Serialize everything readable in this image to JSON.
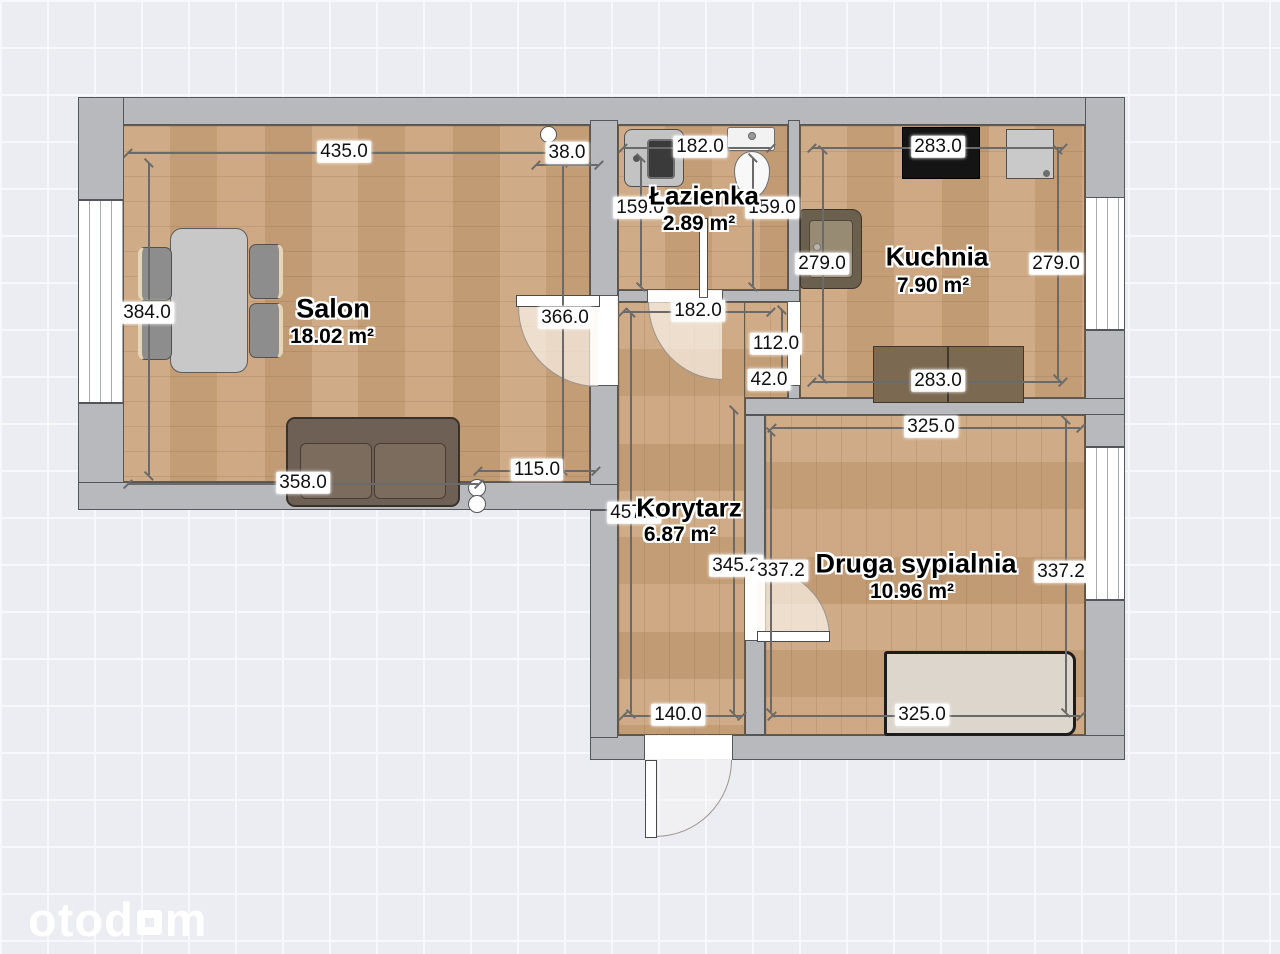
{
  "watermark": {
    "text_before": "otod",
    "text_after": "m"
  },
  "rooms": {
    "salon": {
      "name": "Salon",
      "area": "18.02 m²"
    },
    "lazienka": {
      "name": "Łazienka",
      "area": "2.89 m²"
    },
    "kuchnia": {
      "name": "Kuchnia",
      "area": "7.90 m²"
    },
    "korytarz": {
      "name": "Korytarz",
      "area": "6.87 m²"
    },
    "sypialnia": {
      "name": "Druga sypialnia",
      "area": "10.96 m²"
    }
  },
  "dimensions": {
    "salon_top": "435.0",
    "salon_door_top": "38.0",
    "salon_left": "384.0",
    "salon_right": "366.0",
    "salon_bottom": "358.0",
    "salon_bottom_right": "115.0",
    "bath_top": "182.0",
    "bath_left": "159.0",
    "bath_right": "159.0",
    "bath_door": "182.0",
    "passage_height": "112.0",
    "passage_stub": "42.0",
    "kitchen_top": "283.0",
    "kitchen_left": "279.0",
    "kitchen_right": "279.0",
    "kitchen_bottom": "283.0",
    "bedroom_top": "325.0",
    "bedroom_bottom": "325.0",
    "bedroom_left_inner": "345.2",
    "bedroom_left": "337.2",
    "bedroom_right": "337.2",
    "corridor_height": "457.2",
    "corridor_bottom": "140.0"
  },
  "colors": {
    "wall": "#b7b9bd",
    "wall_outline": "#53565b",
    "floor_wood": "#cba47d",
    "background": "#ecedf2",
    "grid_line": "#f7f8fb",
    "dimension_text": "#101010",
    "watermark": "#ffffff"
  }
}
